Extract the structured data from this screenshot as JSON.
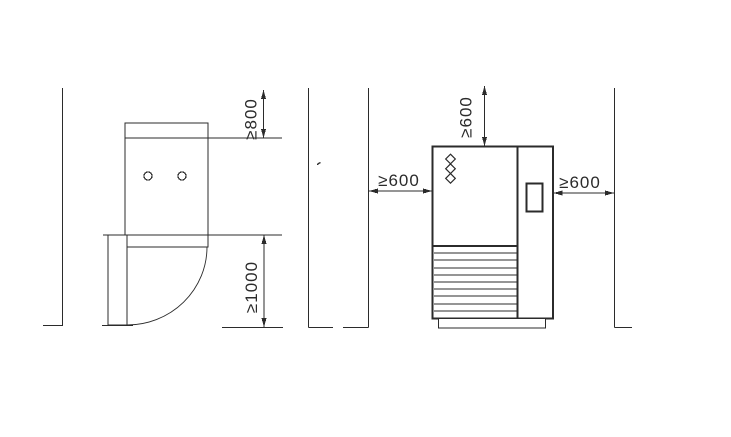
{
  "diagram": {
    "background_color": "#ffffff",
    "line_color": "#2b2b2b",
    "left_view": {
      "dim_top_label": "≥800",
      "dim_bottom_label": "≥1000"
    },
    "right_view": {
      "dim_top_label": "≥600",
      "dim_left_label": "≥600",
      "dim_right_label": "≥600"
    }
  }
}
